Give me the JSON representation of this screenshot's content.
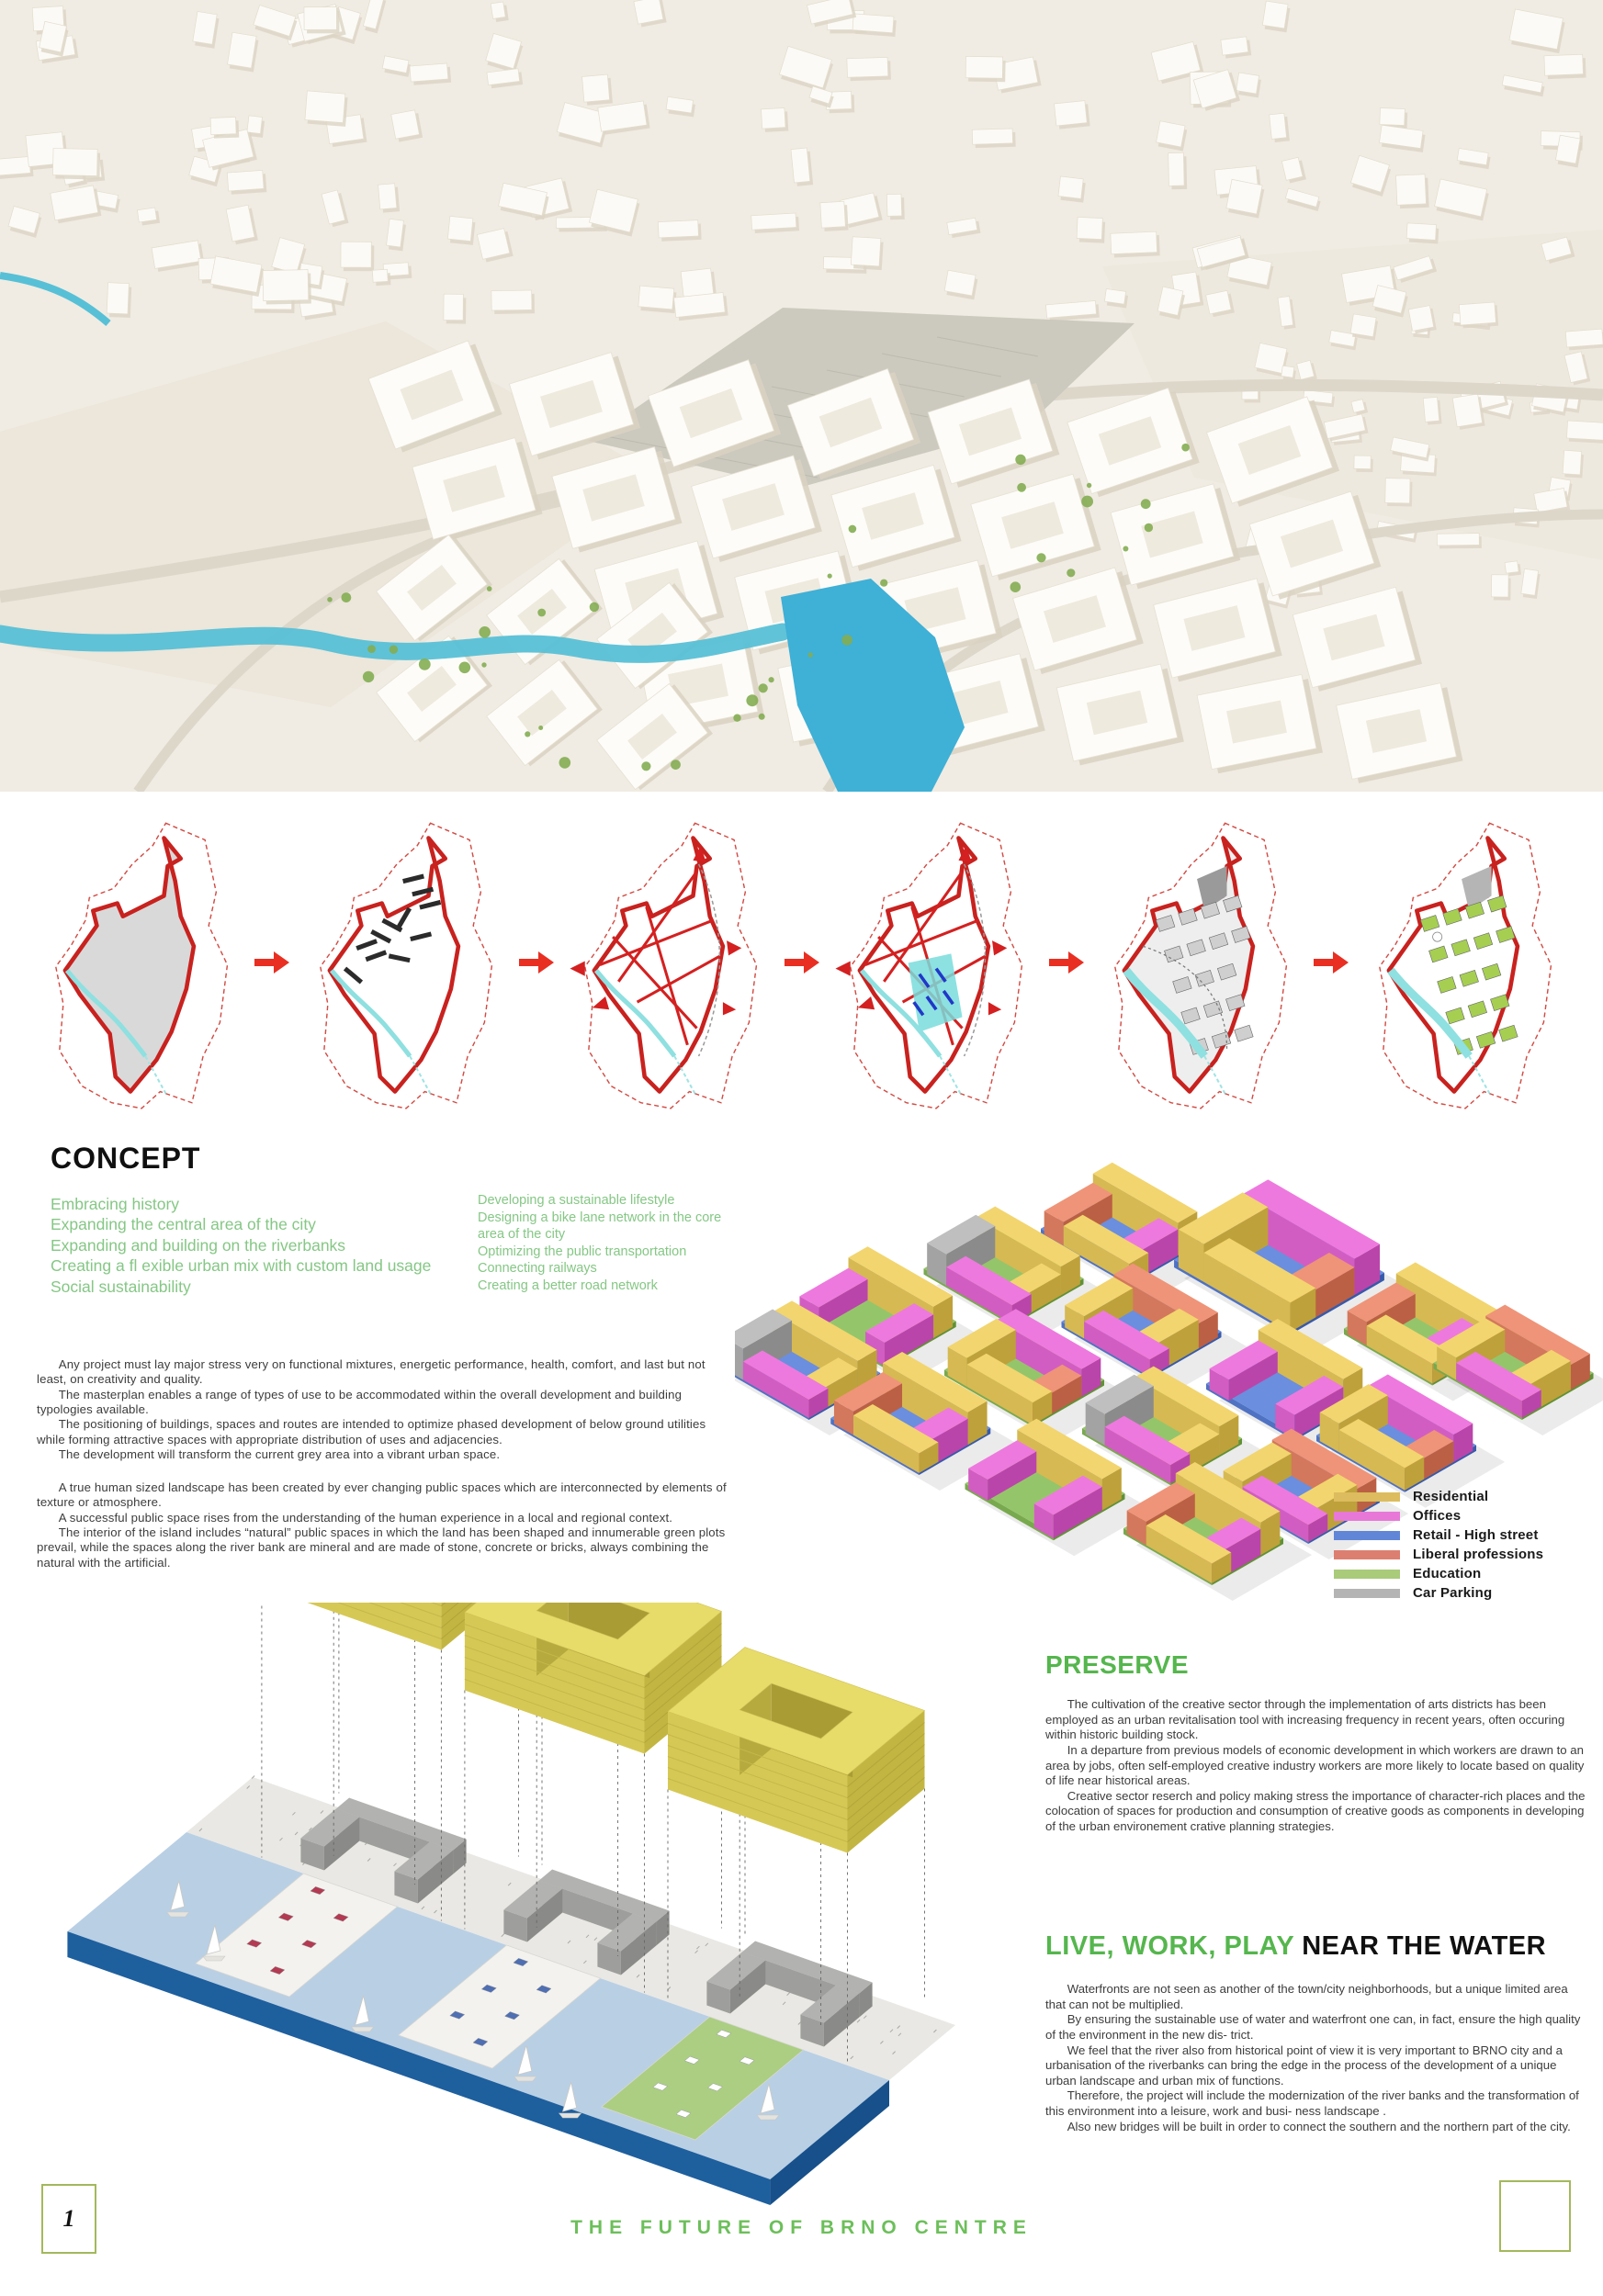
{
  "page": {
    "number": "1",
    "footer_title": "THE FUTURE OF BRNO CENTRE"
  },
  "colors": {
    "accent_green": "#55b64d",
    "list_green": "#85c785",
    "title_green": "#6cbf5a",
    "boundary_red": "#c8221f",
    "arrow_red": "#e82f22",
    "river_teal": "#57c0d6",
    "footer_box_border": "#a3b85c"
  },
  "concept": {
    "heading": "CONCEPT",
    "bullets_left": "Embracing history\nExpanding the central area of the city\nExpanding and building on the riverbanks\nCreating a fl exible urban mix with custom land usage\nSocial sustainability",
    "bullets_right": "Developing a sustainable lifestyle\nDesigning a bike lane network in the core area of the city\nOptimizing the public transportation\nConnecting railways\nCreating a better road network",
    "paragraphs_a": [
      "Any project must lay major stress very on functional mixtures, energetic performance, health, comfort, and last but not least, on creativity and quality.",
      "The masterplan enables a range of types of use to be accommodated within the overall development and building typologies available.",
      "The positioning of buildings, spaces and routes are intended to optimize phased development of below ground utilities while forming attractive spaces with appropriate distribution of uses and adjacencies.",
      "The development will transform the current grey area into a vibrant urban space."
    ],
    "paragraphs_b": [
      "A true human sized landscape has been created by ever changing public spaces which are interconnected by elements of texture or atmosphere.",
      "A successful public space rises from the understanding of the human experience in a local and regional context.",
      "The interior of the island includes “natural” public spaces in which the land has been shaped and innumerable green plots prevail, while the spaces along the river bank are mineral and are made of stone, concrete or bricks, always combining the natural with the artificial."
    ]
  },
  "legend": {
    "items": [
      {
        "label": "Residential",
        "color": "#dcbc5e"
      },
      {
        "label": "Offices",
        "color": "#e878d8"
      },
      {
        "label": "Retail - High street",
        "color": "#6186d8"
      },
      {
        "label": "Liberal professions",
        "color": "#dc7f70"
      },
      {
        "label": "Education",
        "color": "#a9cb7a"
      },
      {
        "label": "Car Parking",
        "color": "#b4b4b4"
      }
    ]
  },
  "preserve": {
    "heading": "PRESERVE",
    "paragraphs": [
      "The cultivation of the creative sector through the implementation of arts districts has been employed as an urban revitalisation tool with increasing frequency in recent years, often occuring within historic building stock.",
      "In a departure from previous models of economic development in which workers are drawn to an area by jobs, often self-employed creative industry workers are more likely to locate based on quality of life near historical areas.",
      "Creative sector reserch and policy making stress the importance of character-rich places and the colocation of spaces for production and consumption of creative goods as components in developing of the urban environement crative planning strategies."
    ]
  },
  "live_work_play": {
    "heading_green": "LIVE, WORK, PLAY",
    "heading_black": " NEAR THE WATER",
    "paragraphs": [
      "Waterfronts are not seen as another of the town/city neighborhoods, but a unique limited area that can not be multiplied.",
      "By ensuring the sustainable use of water and waterfront one can, in fact, ensure the high quality of the environment in the new dis- trict.",
      "We feel that the river also from historical point of view it is very important to BRNO city and a urbanisation of the riverbanks can bring the edge in the process of the development of a unique urban landscape and urban mix of functions.",
      "Therefore, the project will include the modernization of the river banks and the transformation of this environment into a leisure, work and busi- ness landscape .",
      "Also new bridges will be built in order to connect the southern and the northern part of the city."
    ]
  }
}
